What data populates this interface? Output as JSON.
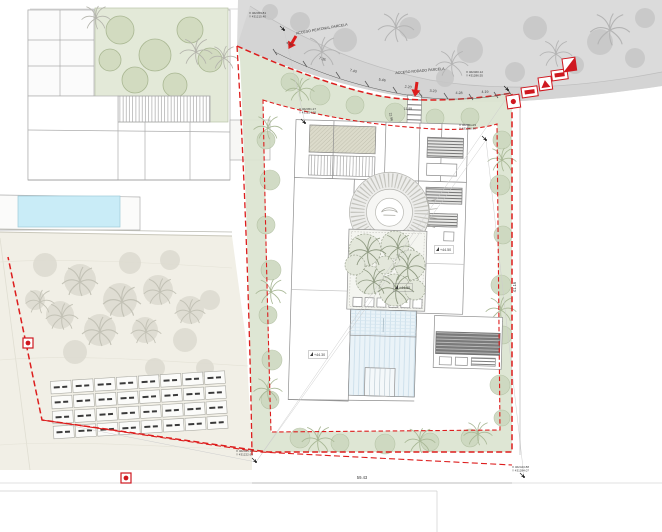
{
  "colors": {
    "boundary_red": "#dd1d1d",
    "marker_red": "#cf1820",
    "green_belt": "#dce5d2",
    "roof_green": "#e3e9d8",
    "pool_blue": "#c9ecf7",
    "water_stripe": "#eaf3f8",
    "road_gray": "#dcdcdc",
    "terrace_beige": "#f1efe6"
  },
  "access_labels": {
    "pedestrian": "ACCESO PEATONAL PARCELA",
    "vehicular": "ACCESO RODADO PARCELA"
  },
  "road_dims": [
    {
      "label": "4.35",
      "x": 289,
      "y": 45,
      "rot": 26
    },
    {
      "label": "7.35",
      "x": 322,
      "y": 60,
      "rot": 19
    },
    {
      "label": "7.40",
      "x": 353,
      "y": 72,
      "rot": 14
    },
    {
      "label": "5.46",
      "x": 382,
      "y": 81,
      "rot": 10
    },
    {
      "label": "2.20",
      "x": 408,
      "y": 88,
      "rot": 7
    },
    {
      "label": "3.23",
      "x": 433,
      "y": 92,
      "rot": 4
    },
    {
      "label": "4.28",
      "x": 459,
      "y": 94,
      "rot": 2
    },
    {
      "label": "4.19",
      "x": 485,
      "y": 93,
      "rot": -1
    }
  ],
  "boundary_dims": [
    {
      "label": "22.96",
      "x": 390,
      "y": 117,
      "rot": 78,
      "size": 3.4
    },
    {
      "label": "11.95",
      "x": 408,
      "y": 110,
      "rot": 0,
      "size": 3.4
    },
    {
      "label": "59.43",
      "x": 362,
      "y": 479,
      "rot": 0,
      "size": 4.2
    },
    {
      "label": "41.16",
      "x": 516,
      "y": 287,
      "rot": -90,
      "size": 4.2
    }
  ],
  "elevations": [
    {
      "label": "+44.50",
      "x": 440,
      "y": 251
    },
    {
      "label": "+44.50",
      "x": 399,
      "y": 289
    },
    {
      "label": "+44.30",
      "x": 314,
      "y": 356
    }
  ],
  "survey_points": [
    {
      "line1": "X 462453.81",
      "line2": "Y 431215.40",
      "x": 249,
      "y": 14,
      "px": 284,
      "py": 30
    },
    {
      "line1": "X 462460.12",
      "line2": "Y 431286.55",
      "x": 466,
      "y": 73,
      "px": 508,
      "py": 90
    },
    {
      "line1": "X 462451.27",
      "line2": "Y 431224.18",
      "x": 299,
      "y": 110,
      "px": 305,
      "py": 123
    },
    {
      "line1": "X 462451.03",
      "line2": "Y 431280.90",
      "x": 459,
      "y": 126,
      "px": 486,
      "py": 140
    },
    {
      "line1": "X 462444.11",
      "line2": "Y 431222.63",
      "x": 236,
      "y": 452,
      "px": 256,
      "py": 462
    },
    {
      "line1": "X 462443.88",
      "line2": "Y 431284.07",
      "x": 512,
      "y": 468,
      "px": 524,
      "py": 477
    }
  ],
  "plan": {
    "garden_grid": {
      "x": 52,
      "y": 376,
      "rows": 4,
      "cols": 8,
      "cw": 20.5,
      "ch": 12.5,
      "gx": 1.5,
      "gy": 2.5,
      "rot": -3.5,
      "cx": 140,
      "cy": 405
    },
    "trees": {
      "road_blobs": [
        [
          300,
          22,
          10
        ],
        [
          345,
          40,
          12
        ],
        [
          410,
          28,
          11
        ],
        [
          470,
          50,
          13
        ],
        [
          535,
          28,
          12
        ],
        [
          600,
          42,
          13
        ],
        [
          645,
          18,
          10
        ],
        [
          445,
          78,
          9
        ],
        [
          515,
          72,
          10
        ],
        [
          575,
          65,
          9
        ],
        [
          635,
          58,
          10
        ],
        [
          270,
          12,
          8
        ]
      ],
      "road_palms": [
        [
          322,
          52,
          1
        ],
        [
          396,
          28,
          1
        ],
        [
          452,
          64,
          0.9
        ],
        [
          610,
          30,
          1.1
        ],
        [
          556,
          54,
          0.9
        ]
      ],
      "roof_olive": [
        [
          120,
          30,
          14
        ],
        [
          155,
          55,
          16
        ],
        [
          190,
          30,
          13
        ],
        [
          135,
          80,
          13
        ],
        [
          175,
          85,
          12
        ],
        [
          210,
          60,
          12
        ],
        [
          110,
          60,
          11
        ]
      ],
      "neighbor_palms": [
        [
          196,
          52,
          0.9
        ],
        [
          224,
          58,
          0.8
        ],
        [
          96,
          18,
          0.8
        ]
      ],
      "terrace_blobs": [
        [
          45,
          265,
          12
        ],
        [
          80,
          280,
          16
        ],
        [
          120,
          300,
          17
        ],
        [
          158,
          290,
          15
        ],
        [
          190,
          310,
          14
        ],
        [
          60,
          315,
          14
        ],
        [
          100,
          330,
          16
        ],
        [
          145,
          330,
          13
        ],
        [
          185,
          340,
          12
        ],
        [
          35,
          300,
          10
        ],
        [
          75,
          352,
          12
        ],
        [
          210,
          300,
          10
        ],
        [
          170,
          260,
          10
        ],
        [
          130,
          263,
          11
        ],
        [
          155,
          368,
          10
        ],
        [
          205,
          368,
          9
        ]
      ],
      "terrace_palms": [
        [
          80,
          282,
          1
        ],
        [
          122,
          302,
          1.05
        ],
        [
          160,
          292,
          0.9
        ],
        [
          100,
          332,
          1
        ],
        [
          62,
          317,
          0.9
        ],
        [
          146,
          332,
          0.85
        ],
        [
          190,
          312,
          0.85
        ],
        [
          40,
          302,
          0.8
        ]
      ],
      "green_blobs": [
        [
          266,
          140,
          9
        ],
        [
          270,
          180,
          10
        ],
        [
          266,
          225,
          9
        ],
        [
          271,
          270,
          10
        ],
        [
          268,
          315,
          9
        ],
        [
          272,
          360,
          10
        ],
        [
          270,
          400,
          9
        ],
        [
          300,
          438,
          10
        ],
        [
          340,
          443,
          9
        ],
        [
          385,
          444,
          10
        ],
        [
          430,
          442,
          9
        ],
        [
          470,
          438,
          9
        ],
        [
          502,
          140,
          9
        ],
        [
          500,
          185,
          10
        ],
        [
          503,
          235,
          9
        ],
        [
          501,
          285,
          10
        ],
        [
          503,
          335,
          9
        ],
        [
          500,
          385,
          10
        ],
        [
          502,
          418,
          8
        ],
        [
          290,
          82,
          9
        ],
        [
          320,
          95,
          10
        ],
        [
          355,
          105,
          9
        ],
        [
          395,
          113,
          10
        ],
        [
          435,
          118,
          9
        ],
        [
          470,
          117,
          9
        ]
      ],
      "green_palms": [
        [
          268,
          128,
          0.8
        ],
        [
          271,
          292,
          0.85
        ],
        [
          268,
          390,
          0.8
        ],
        [
          318,
          440,
          0.9
        ],
        [
          420,
          441,
          0.85
        ],
        [
          478,
          434,
          0.8
        ],
        [
          502,
          160,
          0.8
        ],
        [
          501,
          310,
          0.85
        ],
        [
          300,
          90,
          0.8
        ]
      ],
      "court_blobs": [
        [
          365,
          250,
          16
        ],
        [
          395,
          245,
          14
        ],
        [
          410,
          265,
          15
        ],
        [
          370,
          280,
          14
        ],
        [
          395,
          290,
          16
        ],
        [
          355,
          265,
          10
        ],
        [
          415,
          290,
          10
        ],
        [
          385,
          265,
          9
        ]
      ],
      "court_palms": [
        [
          368,
          252,
          1
        ],
        [
          398,
          248,
          0.9
        ],
        [
          408,
          268,
          0.95
        ],
        [
          374,
          282,
          0.9
        ],
        [
          396,
          290,
          1
        ]
      ]
    }
  }
}
